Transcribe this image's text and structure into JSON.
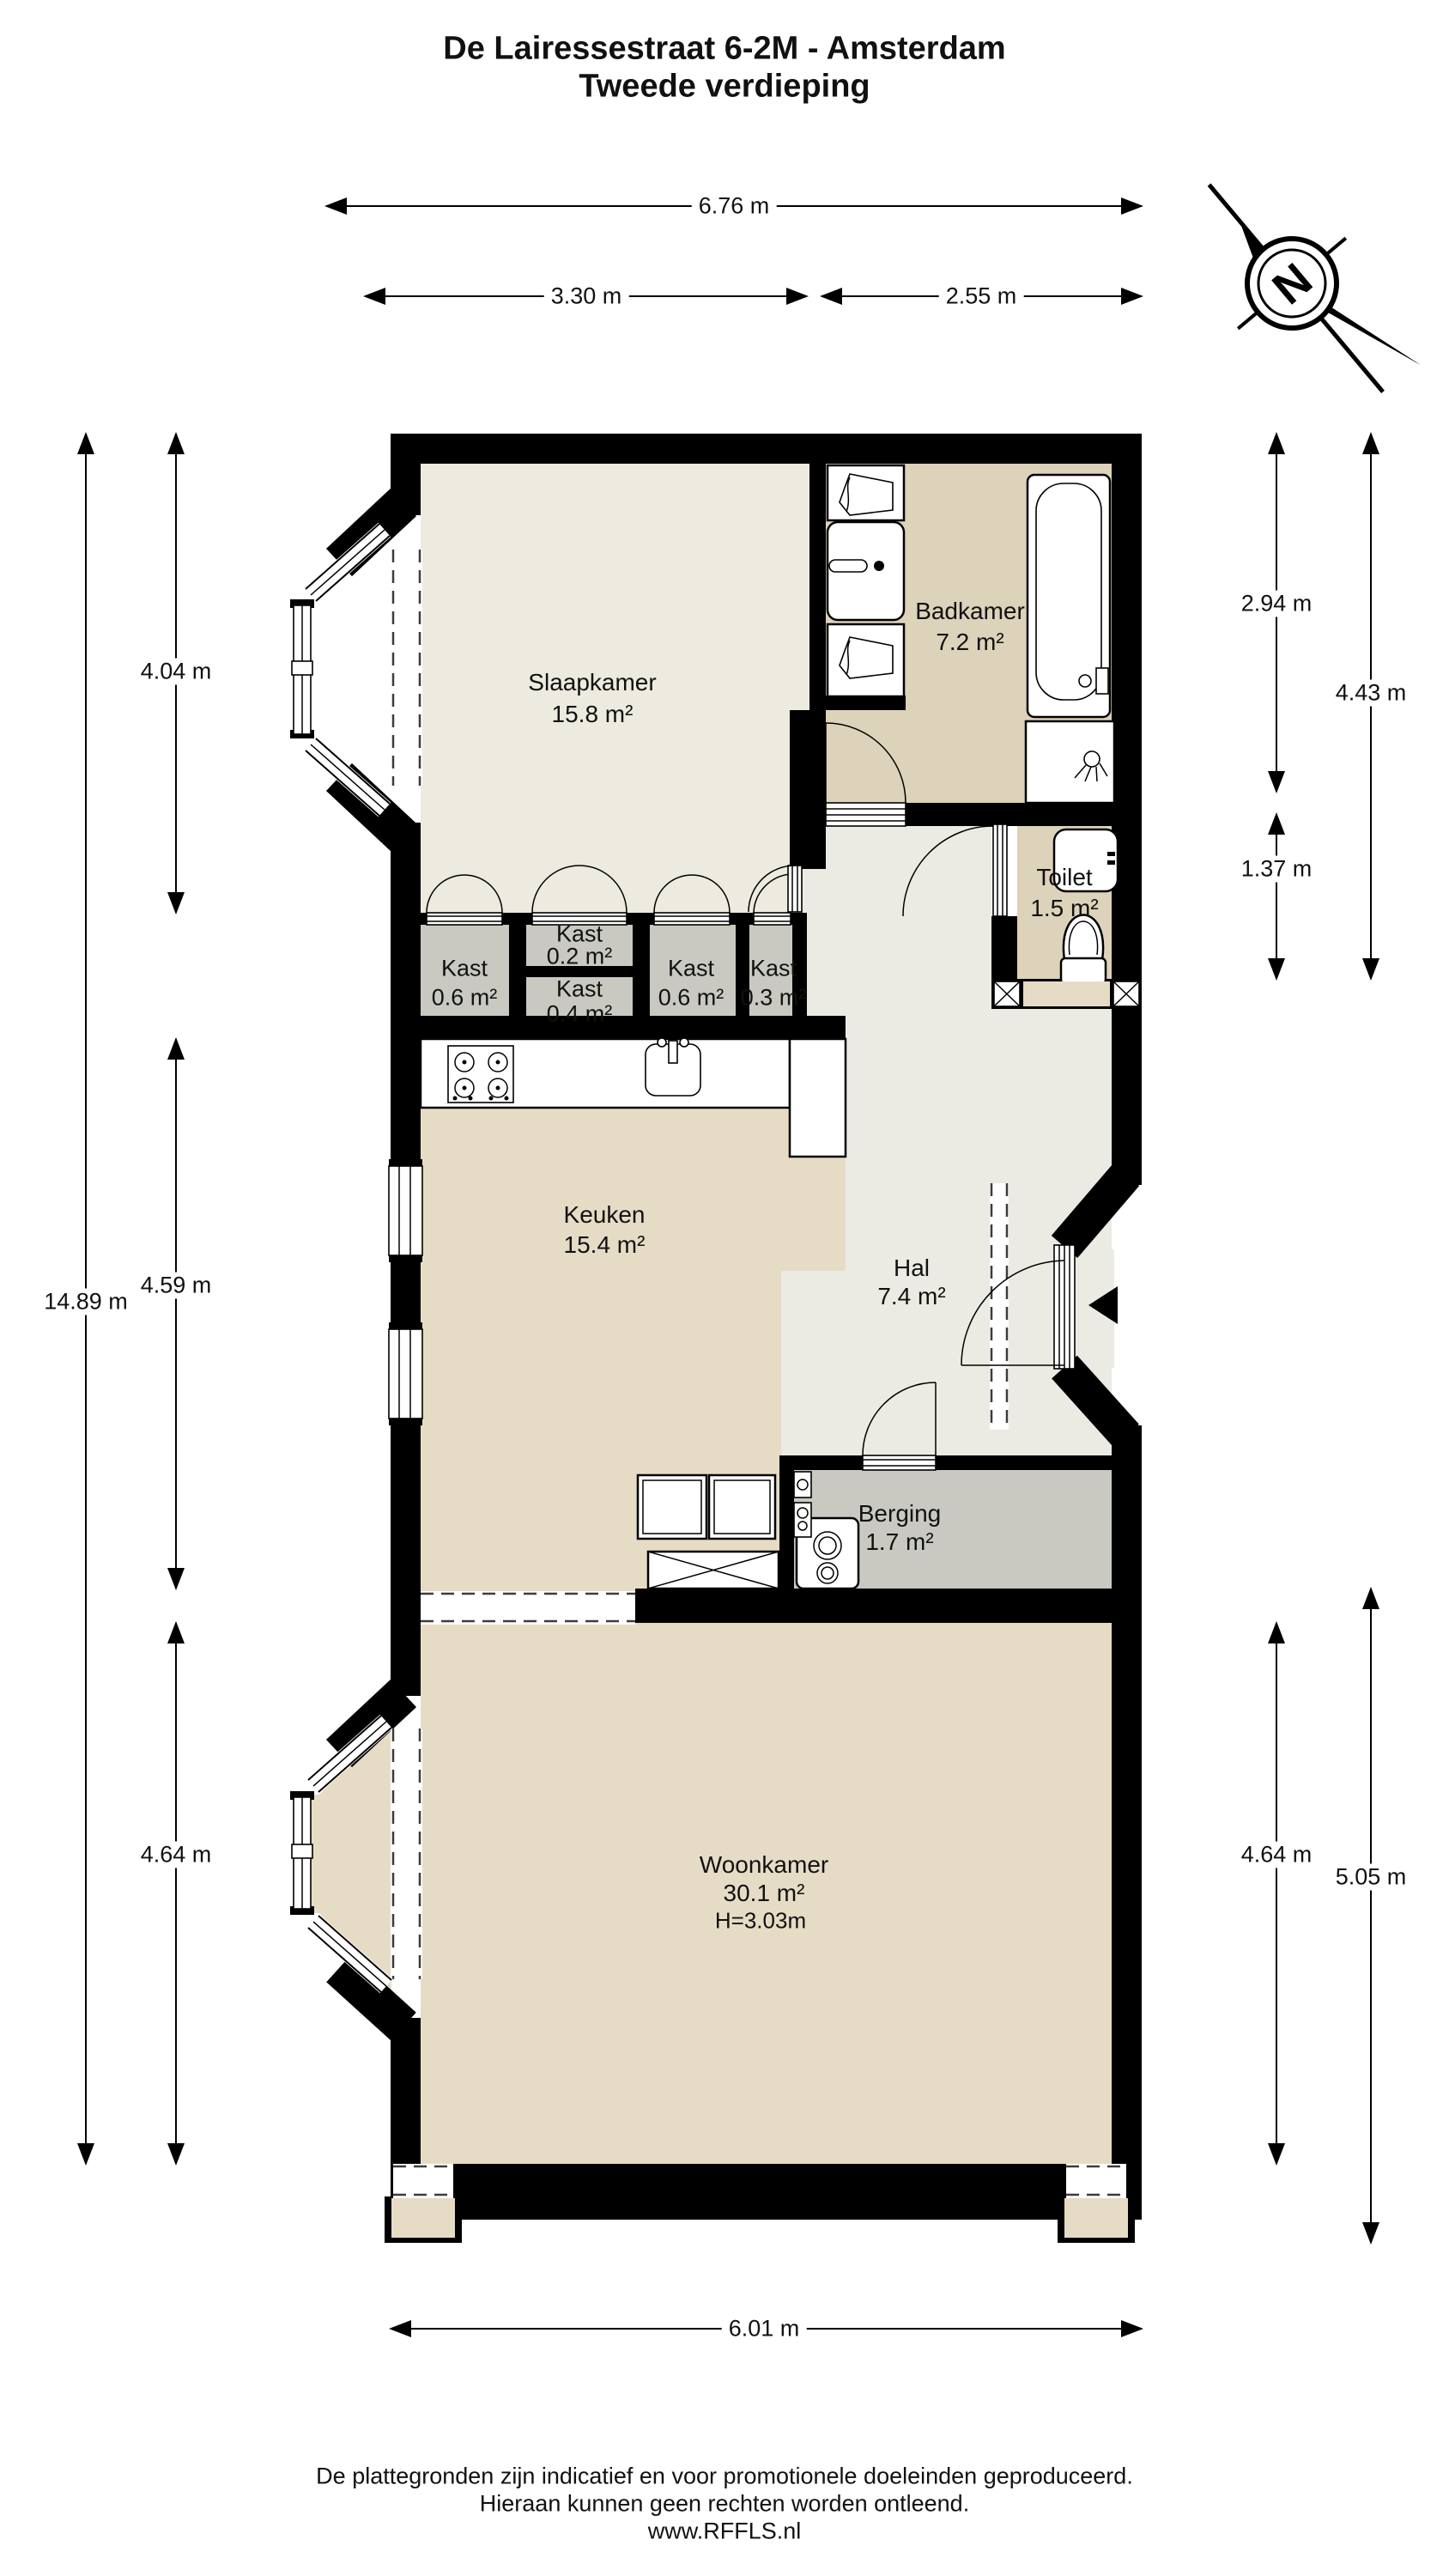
{
  "title": {
    "line1": "De Lairessestraat 6-2M - Amsterdam",
    "line2": "Tweede verdieping"
  },
  "compass": {
    "letter": "N"
  },
  "rooms": [
    {
      "name": "Slaapkamer",
      "area": "15.8 m²"
    },
    {
      "name": "Badkamer",
      "area": "7.2 m²"
    },
    {
      "name": "Toilet",
      "area": "1.5 m²"
    },
    {
      "name": "Kast",
      "area": "0.6 m²"
    },
    {
      "name": "Kast",
      "area": "0.2 m²"
    },
    {
      "name": "Kast",
      "area": "0.4 m²"
    },
    {
      "name": "Kast",
      "area": "0.6 m²"
    },
    {
      "name": "Kast",
      "area": "0.3 m²"
    },
    {
      "name": "Keuken",
      "area": "15.4 m²"
    },
    {
      "name": "Hal",
      "area": "7.4 m²"
    },
    {
      "name": "Berging",
      "area": "1.7 m²"
    },
    {
      "name": "Woonkamer",
      "area": "30.1 m²",
      "height": "H=3.03m"
    }
  ],
  "dims": {
    "total_width": "6.76 m",
    "width_left": "3.30 m",
    "width_right": "2.55 m",
    "total_height": "14.89 m",
    "slaapkamer_h": "4.04 m",
    "keuken_h": "4.59 m",
    "woonkamer_h_left": "4.64 m",
    "badkamer_h": "2.94 m",
    "toilet_h": "1.37 m",
    "right_upper_total": "4.43 m",
    "woonkamer_h_right": "4.64 m",
    "right_lower_total": "5.05 m",
    "bottom_width": "6.01 m"
  },
  "footer": {
    "line1": "De plattegronden zijn indicatief en voor promotionele doeleinden geproduceerd.",
    "line2": "Hieraan kunnen geen rechten worden ontleend.",
    "line3": "www.RFFLS.nl"
  },
  "colors": {
    "wall": "#000000",
    "bedroom": "#edeadf",
    "hal": "#ebebe4",
    "tan": "#e6dcc6",
    "bath": "#ddd2ba",
    "closet": "#c9c9c2",
    "paper": "#ffffff",
    "ink": "#111111"
  }
}
